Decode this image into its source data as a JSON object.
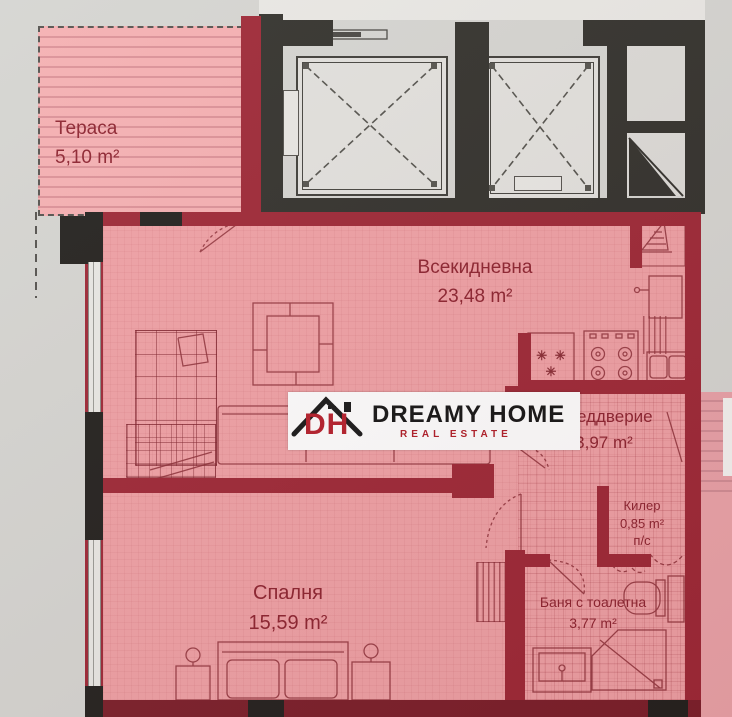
{
  "plan": {
    "rooms": [
      {
        "name": "Тераса",
        "area": "5,10 m²"
      },
      {
        "name": "Всекидневна",
        "area": "23,48 m²"
      },
      {
        "name": "Преддверие",
        "area": "3,97 m²"
      },
      {
        "name": "Килер",
        "area": "0,85 m²",
        "note": "п/с"
      },
      {
        "name": "Спалня",
        "area": "15,59 m²"
      },
      {
        "name": "Баня с тоалетна",
        "area": "3,77 m²"
      }
    ],
    "kitchen_marks": "✳ ✳ ✳",
    "colors": {
      "room_fill": "#efa1a5",
      "wall_red": "#9e2937",
      "wall_dark": "#33322d",
      "terrace_stripe": "#dc9298",
      "label_text": "#8d2430"
    }
  },
  "logo": {
    "monogram": "DH",
    "brand": "DREAMY HOME",
    "tagline": "REAL ESTATE"
  }
}
